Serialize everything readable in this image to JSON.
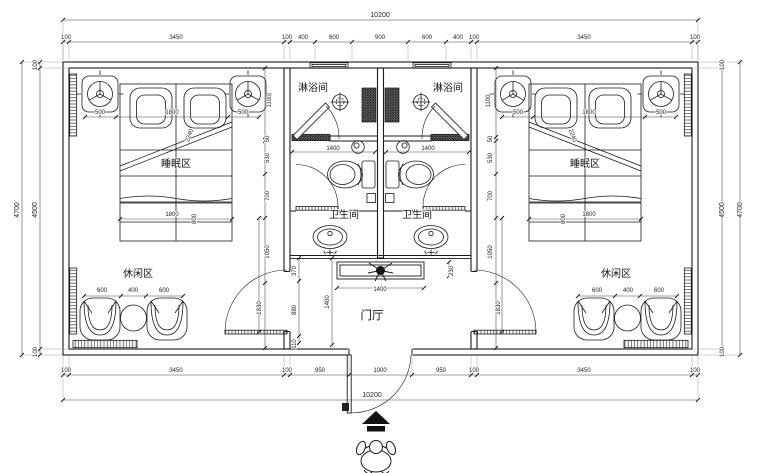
{
  "drawing": {
    "type": "hotel-guestroom-floor-plan",
    "colors": {
      "wall_line": "#1a1a1a",
      "dim_line": "#444444",
      "hatch": "#333333",
      "paper": "#ffffff"
    }
  },
  "rooms": {
    "shower": "淋浴间",
    "toilet": "卫生间",
    "sleep": "睡眠区",
    "leisure": "休闲区",
    "hall": "门厅"
  },
  "dims": {
    "overall_top": "10200",
    "overall_bottom": "10200",
    "top_chain": [
      "100",
      "3450",
      "100",
      "400",
      "600",
      "900",
      "600",
      "400",
      "100",
      "3450",
      "100"
    ],
    "bottom_chain": [
      "100",
      "3450",
      "100",
      "950",
      "1000",
      "950",
      "100",
      "3450",
      "100"
    ],
    "left_top_wall": "100",
    "left_inner": "4500",
    "left_outer": "4700",
    "left_bottom_wall": "100",
    "right_top_wall": "100",
    "right_inner": "4500",
    "right_outer": "4700",
    "right_bottom_wall": "100",
    "bed_chain": [
      "500",
      "1800",
      "500"
    ],
    "side_chain": [
      "1100",
      "50",
      "530",
      "700",
      "1050"
    ],
    "side_door": "1830",
    "bed_width": "1800",
    "bed_foot": "800",
    "bed_diag": "2240",
    "leisure_chain": [
      "600",
      "400",
      "600"
    ],
    "bath_width": "1400",
    "hall_chain": [
      "370",
      "880",
      "110"
    ],
    "hall_depth": "1400",
    "console_width": "1400",
    "console_depth": "230"
  }
}
